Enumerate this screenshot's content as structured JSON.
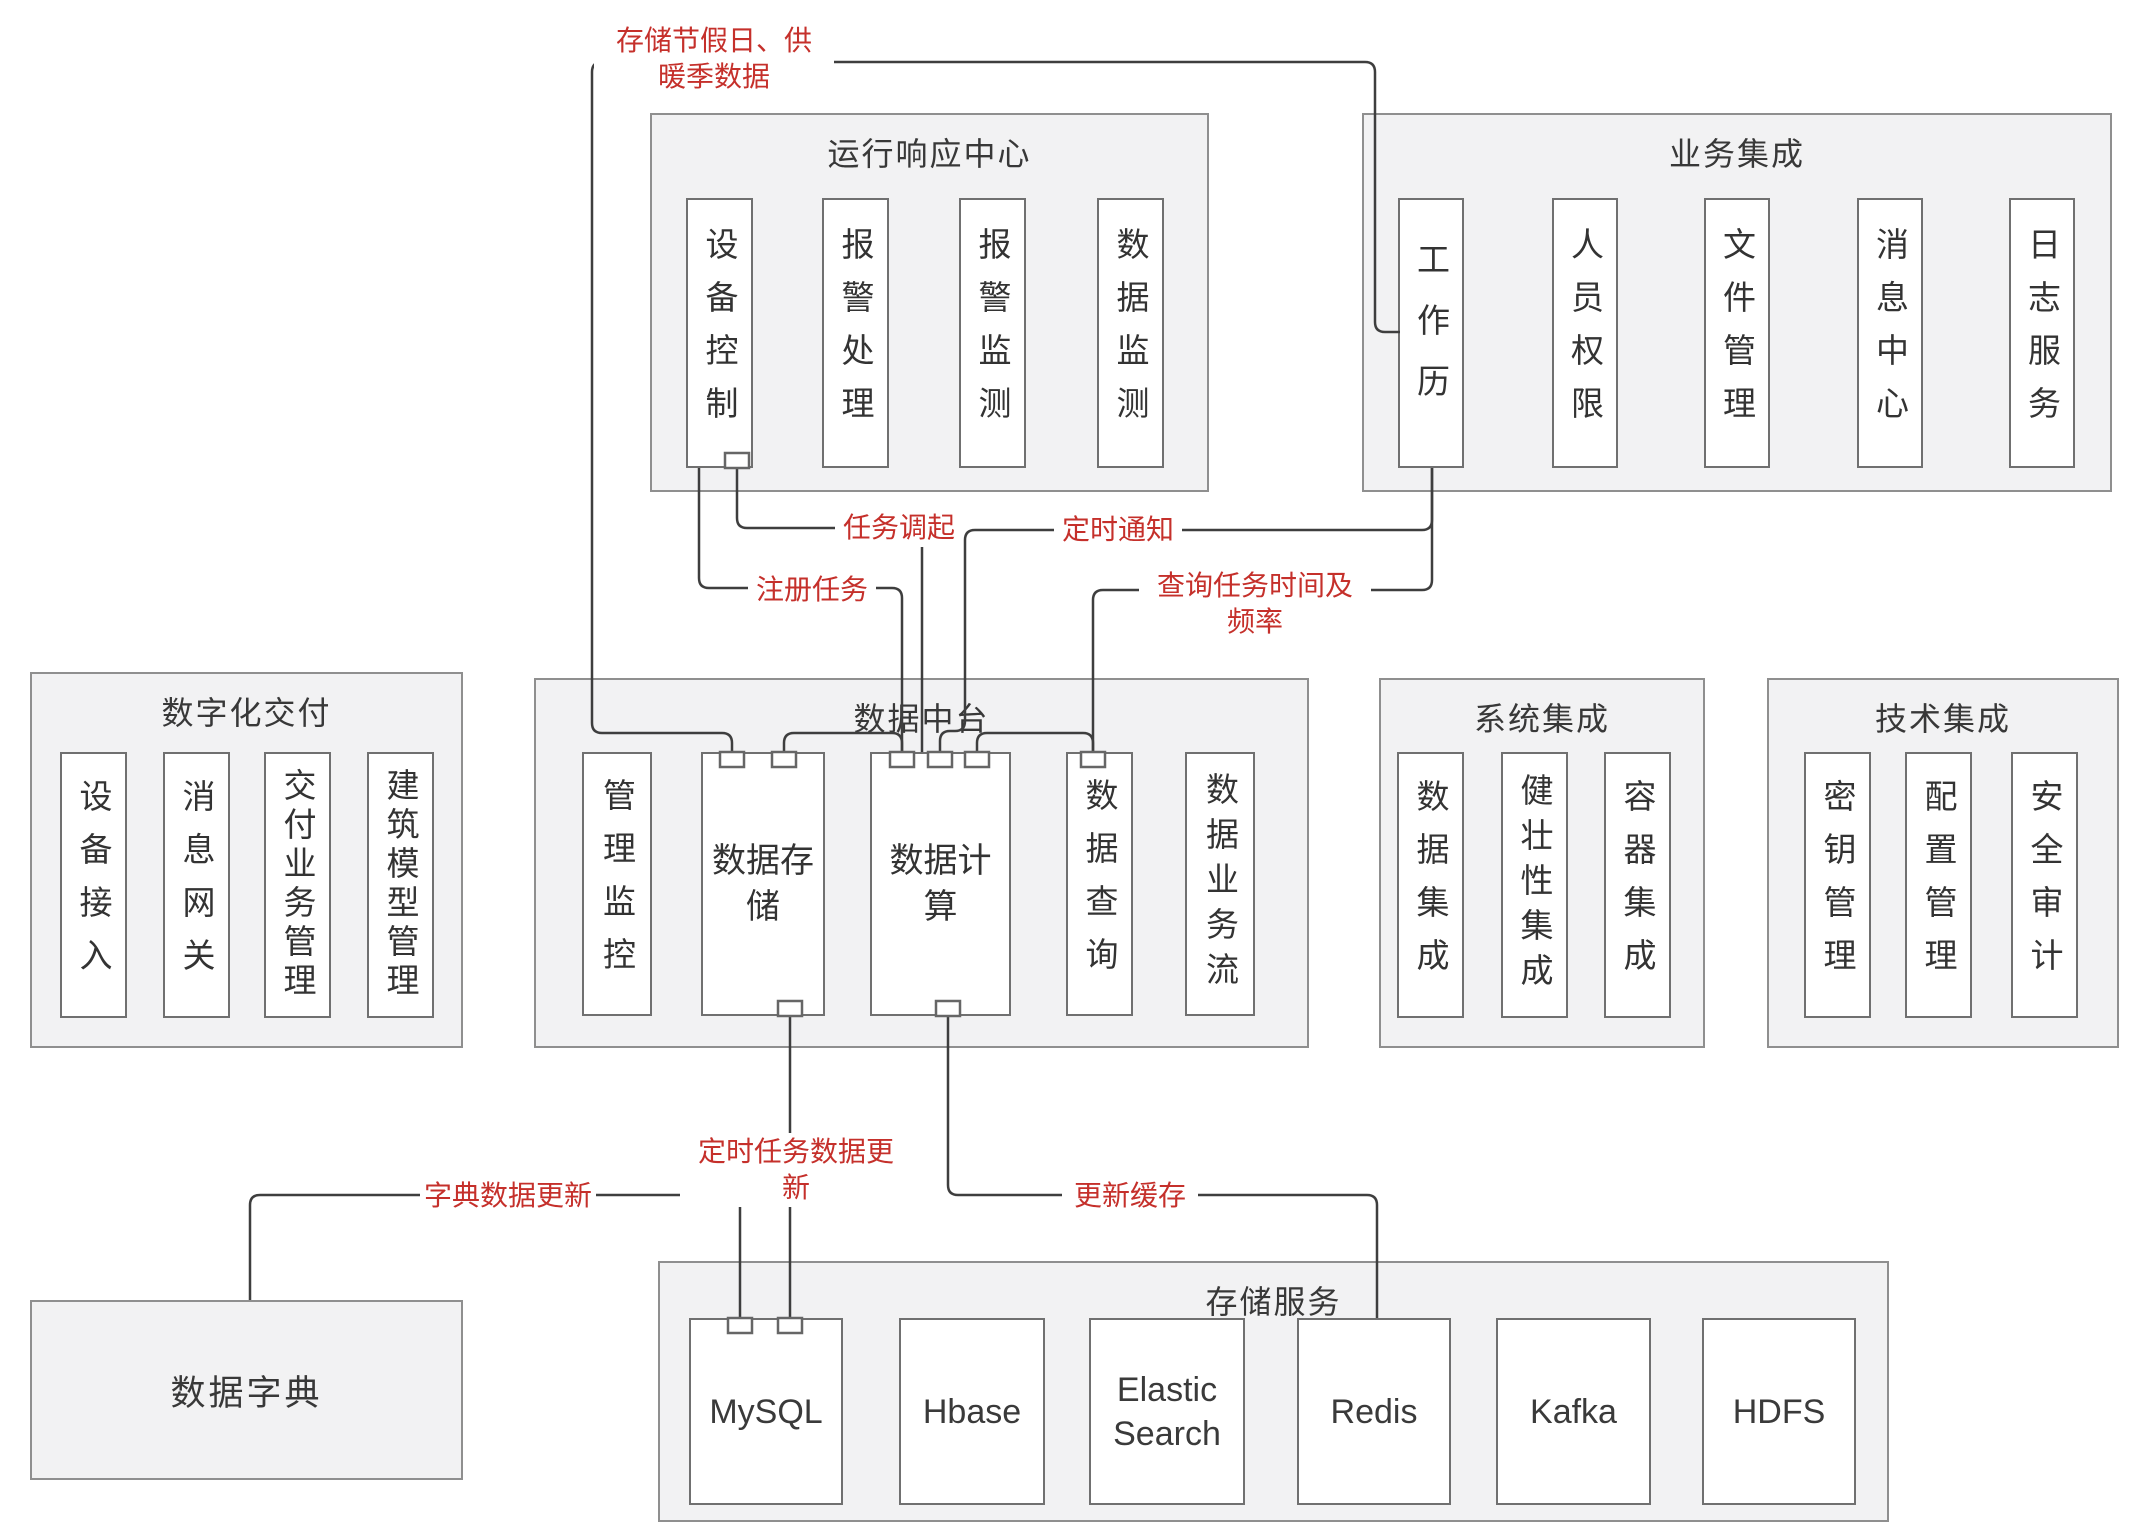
{
  "colors": {
    "red_label": "#c5302b",
    "line": "#3e3e3e",
    "section_bg": "#f2f2f3",
    "section_border": "#8f8f8f",
    "node_border": "#707070"
  },
  "sections": {
    "op_center": {
      "title": "运行响应中心",
      "items": [
        "设备控制",
        "报警处理",
        "报警监测",
        "数据监测"
      ]
    },
    "biz_integration": {
      "title": "业务集成",
      "items": [
        "工作历",
        "人员权限",
        "文件管理",
        "消息中心",
        "日志服务"
      ]
    },
    "digital_delivery": {
      "title": "数字化交付",
      "items": [
        "设备接入",
        "消息网关",
        "交付业务管理",
        "建筑模型管理"
      ]
    },
    "data_platform": {
      "title": "数据中台",
      "items": [
        "管理监控",
        "数据存储",
        "数据计算",
        "数据查询",
        "数据业务流"
      ]
    },
    "system_integration": {
      "title": "系统集成",
      "items": [
        "数据集成",
        "健壮性集成",
        "容器集成"
      ]
    },
    "tech_integration": {
      "title": "技术集成",
      "items": [
        "密钥管理",
        "配置管理",
        "安全审计"
      ]
    },
    "storage_service": {
      "title": "存储服务",
      "items": [
        "MySQL",
        "Hbase",
        "Elastic Search",
        "Redis",
        "Kafka",
        "HDFS"
      ]
    },
    "data_dictionary": {
      "title": "数据字典"
    }
  },
  "edge_labels": {
    "store_seasonal": {
      "lines": [
        "存储节假日、供",
        "暖季数据"
      ]
    },
    "invoke_task": {
      "text": "任务调起"
    },
    "timed_notify": {
      "text": "定时通知"
    },
    "register_task": {
      "text": "注册任务"
    },
    "query_task_schedule": {
      "lines": [
        "查询任务时间及",
        "频率"
      ]
    },
    "timed_data_update": {
      "lines": [
        "定时任务数据更",
        "新"
      ]
    },
    "dict_data_update": {
      "text": "字典数据更新"
    },
    "update_cache": {
      "text": "更新缓存"
    }
  }
}
